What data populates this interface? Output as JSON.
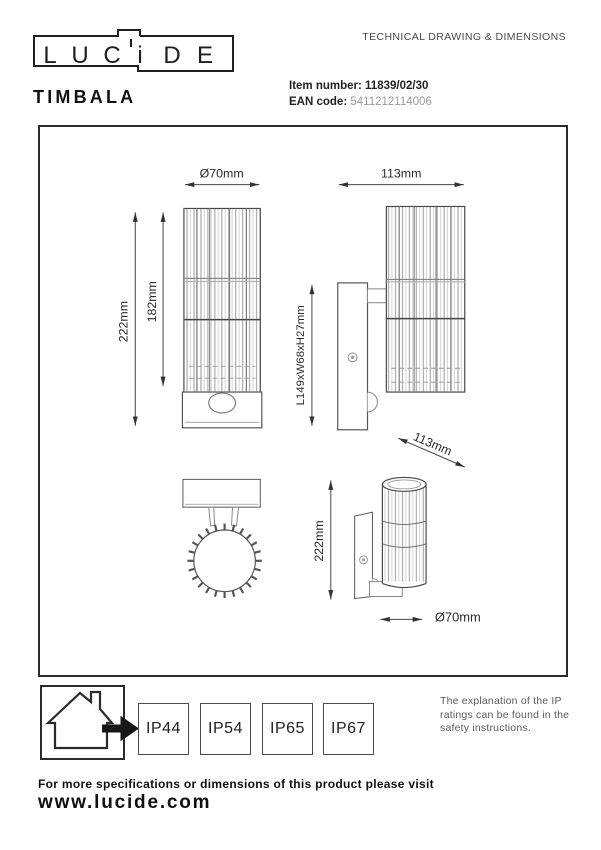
{
  "header": {
    "logo": {
      "letters": [
        "L",
        "U",
        "C",
        "i",
        "D",
        "E"
      ]
    },
    "tagline": "TECHNICAL DRAWING & DIMENSIONS",
    "product_name": "TIMBALA",
    "item": {
      "label": "Item number:",
      "value": "11839/02/30"
    },
    "ean": {
      "label": "EAN code:",
      "value": "5411212114006"
    }
  },
  "drawing": {
    "dims": {
      "front_diameter": "Ø70mm",
      "front_total_height": "222mm",
      "front_shade_height": "182mm",
      "side_width": "113mm",
      "side_bracket": "L149xW68xH27mm",
      "side_depth": "113mm",
      "persp_height": "222mm",
      "persp_diameter": "Ø70mm"
    }
  },
  "footer": {
    "ip_ratings": [
      "IP44",
      "IP54",
      "IP65",
      "IP67"
    ],
    "ip_note": "The explanation of the IP ratings can be found in the safety instructions.",
    "visit_text": "For more specifications or dimensions of this product please visit",
    "website": "www.lucide.com"
  }
}
